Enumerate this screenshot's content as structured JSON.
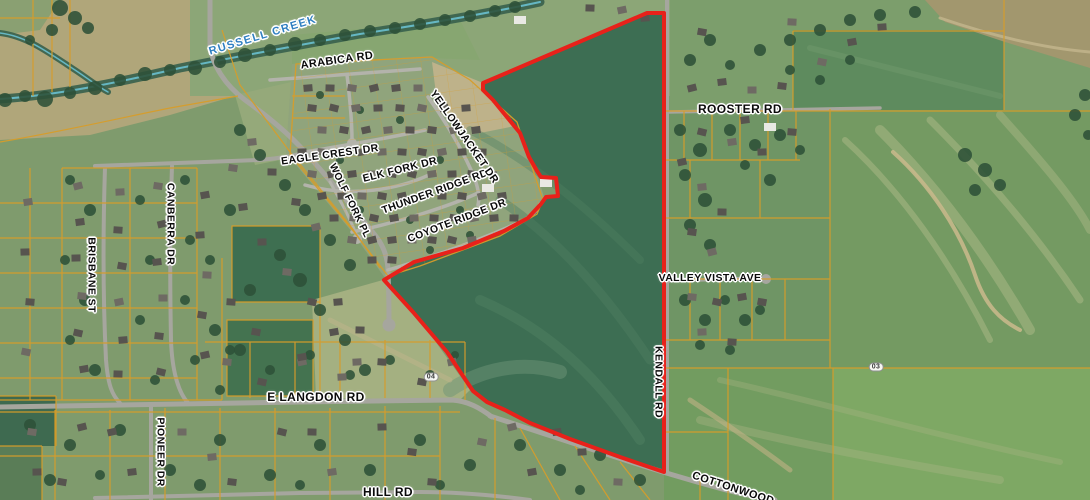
{
  "map": {
    "type": "aerial-parcel-map",
    "description": "Aerial imagery with tax parcels (yellow) and a red project boundary along Kendall Rd",
    "boundary_color": "#e8211a",
    "parcel_line_color": "#d79d2a",
    "creek_color": "#69c0cf",
    "labels": [
      {
        "id": "russell-creek",
        "text": "RUSSELL CREEK",
        "x": 263,
        "y": 36,
        "rot": -17,
        "size": 11,
        "kind": "creek"
      },
      {
        "id": "arabica-rd",
        "text": "ARABICA RD",
        "x": 337,
        "y": 61,
        "rot": -8,
        "size": 11,
        "kind": "street"
      },
      {
        "id": "eagle-crest-dr",
        "text": "EAGLE CREST DR",
        "x": 330,
        "y": 155,
        "rot": -8,
        "size": 10.5,
        "kind": "street"
      },
      {
        "id": "elk-fork-dr",
        "text": "ELK FORK DR",
        "x": 400,
        "y": 170,
        "rot": -14,
        "size": 10.5,
        "kind": "street"
      },
      {
        "id": "wolf-fork-pl",
        "text": "WOLF FORK PL",
        "x": 349,
        "y": 201,
        "rot": 64,
        "size": 10,
        "kind": "street"
      },
      {
        "id": "thunder-ridge-rd",
        "text": "THUNDER RIDGE RD",
        "x": 435,
        "y": 192,
        "rot": -20,
        "size": 10.5,
        "kind": "street"
      },
      {
        "id": "yellowjacket-dr",
        "text": "YELLOWJACKET DR",
        "x": 464,
        "y": 137,
        "rot": 55,
        "size": 10.5,
        "kind": "street"
      },
      {
        "id": "coyote-ridge-dr",
        "text": "COYOTE RIDGE DR",
        "x": 457,
        "y": 221,
        "rot": -21,
        "size": 10.5,
        "kind": "street"
      },
      {
        "id": "brisbane-st",
        "text": "BRISBANE ST",
        "x": 91,
        "y": 275,
        "rot": 90,
        "size": 10.5,
        "kind": "street"
      },
      {
        "id": "canberra-dr",
        "text": "CANBERRA DR",
        "x": 170,
        "y": 224,
        "rot": 90,
        "size": 10.5,
        "kind": "street"
      },
      {
        "id": "rooster-rd",
        "text": "ROOSTER RD",
        "x": 740,
        "y": 109,
        "rot": 0,
        "size": 12,
        "kind": "street"
      },
      {
        "id": "valley-vista-ave",
        "text": "VALLEY VISTA AVE",
        "x": 710,
        "y": 278,
        "rot": 0,
        "size": 10.5,
        "kind": "street"
      },
      {
        "id": "kendall-rd",
        "text": "KENDALL RD",
        "x": 658,
        "y": 382,
        "rot": 90,
        "size": 10.5,
        "kind": "street"
      },
      {
        "id": "e-langdon-rd",
        "text": "E LANGDON RD",
        "x": 316,
        "y": 397,
        "rot": 0,
        "size": 12,
        "kind": "street"
      },
      {
        "id": "pioneer-dr",
        "text": "PIONEER DR",
        "x": 160,
        "y": 452,
        "rot": 90,
        "size": 10.5,
        "kind": "street"
      },
      {
        "id": "hill-rd",
        "text": "HILL RD",
        "x": 388,
        "y": 492,
        "rot": 0,
        "size": 12,
        "kind": "street"
      },
      {
        "id": "cottonwood",
        "text": "COTTONWOOD",
        "x": 733,
        "y": 489,
        "rot": 18,
        "size": 11,
        "kind": "street"
      },
      {
        "id": "marker-04",
        "text": "04",
        "x": 431,
        "y": 377,
        "rot": 0,
        "size": 7,
        "kind": "marker"
      },
      {
        "id": "marker-03",
        "text": "03",
        "x": 876,
        "y": 367,
        "rot": 0,
        "size": 7,
        "kind": "marker"
      }
    ]
  }
}
